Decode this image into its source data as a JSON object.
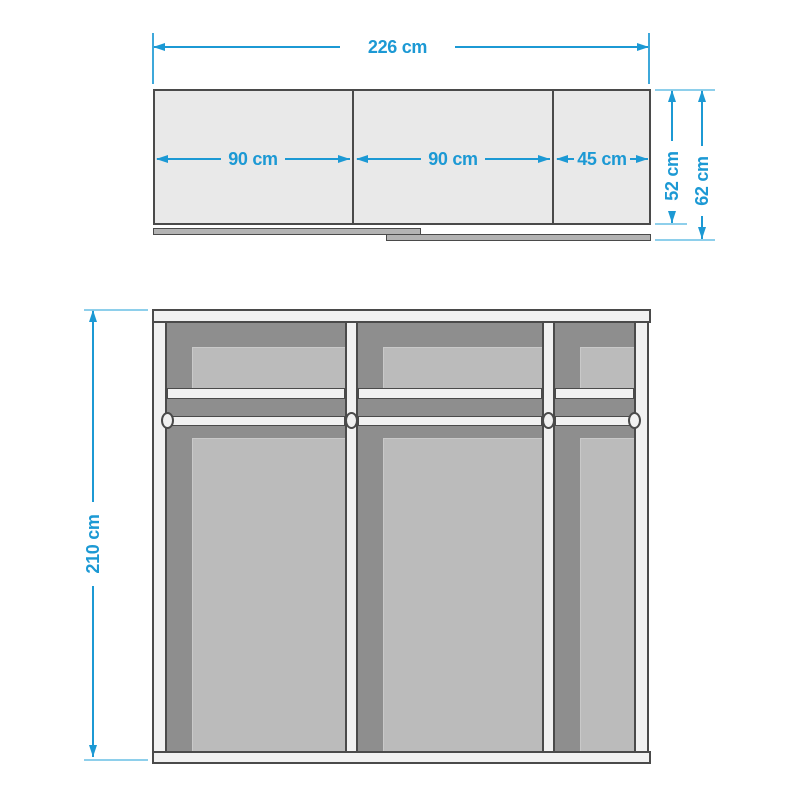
{
  "colors": {
    "accent": "#1c99d4",
    "tick": "#8ecfeb",
    "outline": "#4a4a4a",
    "panel_fill": "#e9e9e9",
    "frame_fill": "#f1f1f1",
    "backing_dark": "#8e8e8e",
    "inset_light": "#bbbbbb",
    "track_fill": "#b3b3b3"
  },
  "top_view": {
    "total_width_label": "226 cm",
    "door_labels": [
      "90 cm",
      "90 cm",
      "45 cm"
    ],
    "depth_body_label": "52 cm",
    "depth_overall_label": "62 cm"
  },
  "front_view": {
    "height_label": "210 cm"
  }
}
